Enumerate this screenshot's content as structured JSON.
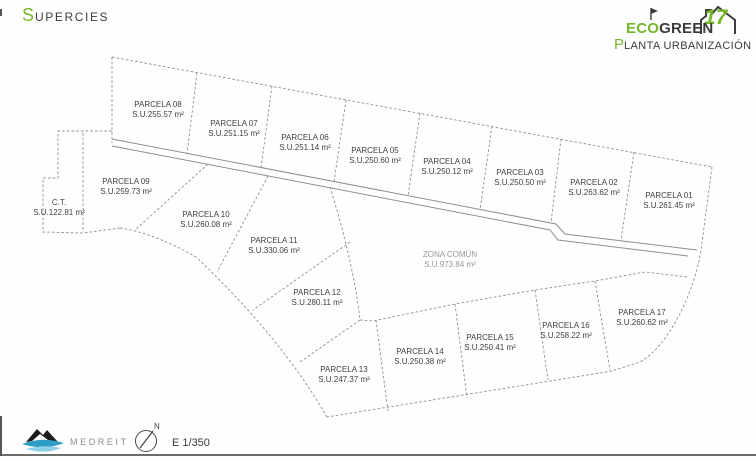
{
  "header": {
    "title_initial": "S",
    "title_rest": "UPERCIES"
  },
  "logo": {
    "eco": "ECO",
    "green": "GREEN",
    "number": "17",
    "subtitle_initial": "P",
    "subtitle_rest": "LANTA URBANIZACIÓN"
  },
  "plan": {
    "parcels": [
      {
        "name": "PARCELA 01",
        "area": "S.U.261.45 m²",
        "x": 669,
        "y": 191
      },
      {
        "name": "PARCELA 02",
        "area": "S.U.263.62 m²",
        "x": 594,
        "y": 178
      },
      {
        "name": "PARCELA 03",
        "area": "S.U.250.50 m²",
        "x": 520,
        "y": 168
      },
      {
        "name": "PARCELA 04",
        "area": "S.U.250.12 m²",
        "x": 447,
        "y": 157
      },
      {
        "name": "PARCELA 05",
        "area": "S.U.250.60 m²",
        "x": 375,
        "y": 146
      },
      {
        "name": "PARCELA 06",
        "area": "S.U.251.14 m²",
        "x": 305,
        "y": 133
      },
      {
        "name": "PARCELA 07",
        "area": "S.U.251.15 m²",
        "x": 234,
        "y": 119
      },
      {
        "name": "PARCELA 08",
        "area": "S.U.255.57 m²",
        "x": 158,
        "y": 100
      },
      {
        "name": "PARCELA 09",
        "area": "S.U.259.73 m²",
        "x": 126,
        "y": 177
      },
      {
        "name": "C.T.",
        "area": "S.U.122.81 m²",
        "x": 59,
        "y": 198
      },
      {
        "name": "PARCELA 10",
        "area": "S.U.260.08 m²",
        "x": 206,
        "y": 210
      },
      {
        "name": "PARCELA 11",
        "area": "S.U.330.06 m²",
        "x": 274,
        "y": 236
      },
      {
        "name": "ZONA COMÚN",
        "area": "S.U.973.84 m²",
        "x": 450,
        "y": 250,
        "muted": true
      },
      {
        "name": "PARCELA 12",
        "area": "S.U.280.11 m²",
        "x": 317,
        "y": 288
      },
      {
        "name": "PARCELA 13",
        "area": "S.U.247.37 m²",
        "x": 344,
        "y": 365
      },
      {
        "name": "PARCELA 14",
        "area": "S.U.250.38 m²",
        "x": 420,
        "y": 347
      },
      {
        "name": "PARCELA 15",
        "area": "S.U.250.41 m²",
        "x": 490,
        "y": 333
      },
      {
        "name": "PARCELA 16",
        "area": "S.U.258.22 m²",
        "x": 566,
        "y": 321
      },
      {
        "name": "PARCELA 17",
        "area": "S.U.260.62 m²",
        "x": 642,
        "y": 308
      }
    ]
  },
  "footer": {
    "brand": "MEDREIT",
    "scale": "E 1/350",
    "compass_n": "N"
  },
  "colors": {
    "green": "#76b72a",
    "dark": "#3c3c3b",
    "plan_line": "#8f8f8f",
    "label_text": "#3f3f3e",
    "brand_blue": "#2e9dc6"
  }
}
